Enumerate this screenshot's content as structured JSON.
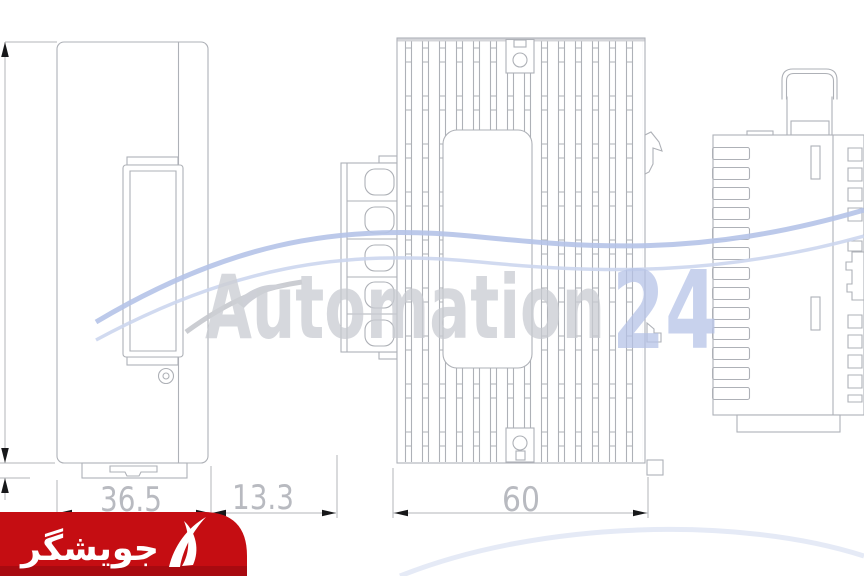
{
  "dimensions": {
    "front_width": "36.5",
    "terminal_depth": "13.3",
    "side_width": "60"
  },
  "watermark": {
    "brand": "Automation",
    "suffix": "24"
  },
  "vendor_badge": {
    "label": "جویشگر"
  },
  "colors": {
    "line": "#aeb1b7",
    "dimension_text": "#b8bac0",
    "arrow": "#17181a",
    "watermark_gray": "#c8cad1",
    "watermark_blue": "#b4c2e6",
    "logo_red": "#c50d12",
    "logo_dark_red": "#8f0a0e",
    "logo_text": "#ffffff"
  }
}
